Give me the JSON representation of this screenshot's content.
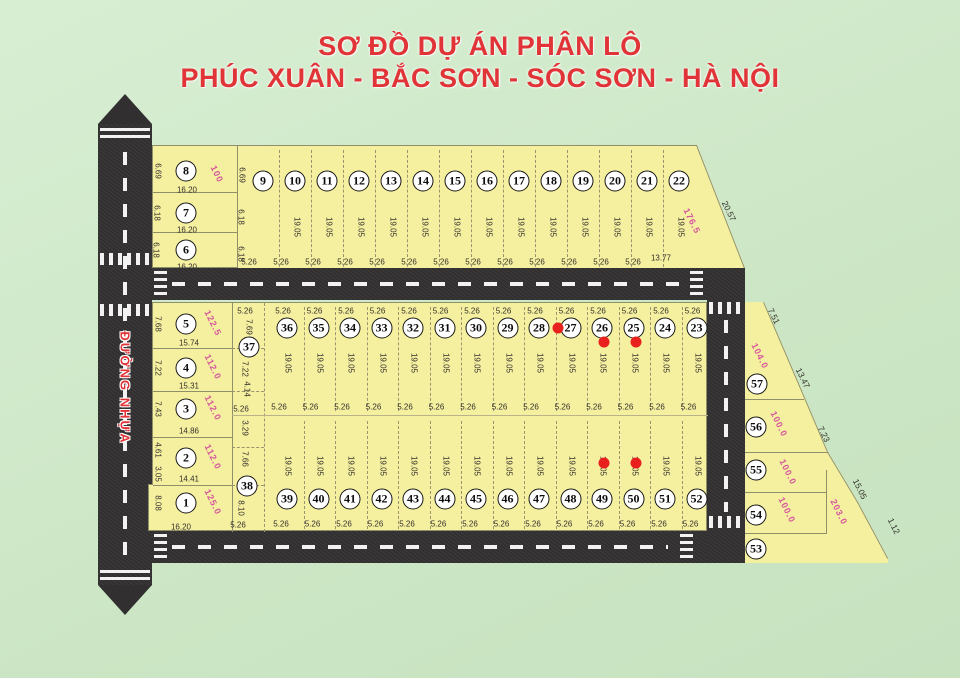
{
  "title": {
    "line1": "SƠ ĐỒ DỰ ÁN PHÂN LÔ",
    "line2": "PHÚC XUÂN - BẮC SƠN - SÓC SƠN - HÀ NỘI"
  },
  "road_label": "ĐƯỜNG NHỰA",
  "colors": {
    "background": "#cde7c6",
    "plot_fill": "#f5efa0",
    "road": "#312f30",
    "title_red": "#e13438",
    "area_pink": "#d6559c",
    "sold_dot": "#e8211f",
    "dim_text": "#33302a",
    "boundary_line": "#8f8f6a"
  },
  "top_left_block": {
    "plots": [
      {
        "num": "8",
        "left": "6.69",
        "right": "6.69",
        "bottom": "16.20",
        "area": "100"
      },
      {
        "num": "7",
        "left": "6.18",
        "right": "6.18",
        "bottom": "16.20"
      },
      {
        "num": "6",
        "left": "6.18",
        "right": "6.18",
        "bottom": "16.20"
      }
    ]
  },
  "top_row": {
    "plots": [
      {
        "num": "9",
        "width": "5.26"
      },
      {
        "num": "10",
        "width": "5.26",
        "depth": "19.05"
      },
      {
        "num": "11",
        "width": "5.26",
        "depth": "19.05"
      },
      {
        "num": "12",
        "width": "5.26",
        "depth": "19.05"
      },
      {
        "num": "13",
        "width": "5.26",
        "depth": "19.05"
      },
      {
        "num": "14",
        "width": "5.26",
        "depth": "19.05"
      },
      {
        "num": "15",
        "width": "5.26",
        "depth": "19.05"
      },
      {
        "num": "16",
        "width": "5.26",
        "depth": "19.05"
      },
      {
        "num": "17",
        "width": "5.26",
        "depth": "19.05"
      },
      {
        "num": "18",
        "width": "5.26",
        "depth": "19.05"
      },
      {
        "num": "19",
        "width": "5.26",
        "depth": "19.05"
      },
      {
        "num": "20",
        "width": "5.26",
        "depth": "19.05"
      },
      {
        "num": "21",
        "width": "5.26",
        "depth": "19.05"
      },
      {
        "num": "22",
        "width": "13.77",
        "depth": "19.05",
        "area": "176.5",
        "slant": "20.57"
      }
    ]
  },
  "left_block": {
    "plots": [
      {
        "num": "5",
        "side": "7.68",
        "bottom": "15.74",
        "area": "122.5"
      },
      {
        "num": "4",
        "side": "7.22",
        "bottom": "15.31",
        "area": "112.0"
      },
      {
        "num": "3",
        "side": "7.43",
        "bottom": "14.86",
        "area": "112.0"
      },
      {
        "num": "2",
        "side": "4.61",
        "side2": "3.05",
        "bottom": "14.41",
        "area": "112.0"
      },
      {
        "num": "1",
        "side": "8.08",
        "bottom": "16.20",
        "area": "125.0"
      }
    ]
  },
  "mid_column": {
    "top_width": "5.26",
    "upper_num": "37",
    "upper_segments": [
      "7.69",
      "7.22",
      "4.14"
    ],
    "mid_width": "5.26",
    "lower_segments": [
      "3.29",
      "7.66",
      "8.10"
    ],
    "lower_num": "38",
    "bottom_width": "5.26"
  },
  "row2": {
    "plots": [
      {
        "num": "36",
        "top": "5.26",
        "depth": "19.05",
        "mid": "5.26"
      },
      {
        "num": "35",
        "top": "5.26",
        "depth": "19.05",
        "mid": "5.26"
      },
      {
        "num": "34",
        "top": "5.26",
        "depth": "19.05",
        "mid": "5.26"
      },
      {
        "num": "33",
        "top": "5.26",
        "depth": "19.05",
        "mid": "5.26"
      },
      {
        "num": "32",
        "top": "5.26",
        "depth": "19.05",
        "mid": "5.26"
      },
      {
        "num": "31",
        "top": "5.26",
        "depth": "19.05",
        "mid": "5.26"
      },
      {
        "num": "30",
        "top": "5.26",
        "depth": "19.05",
        "mid": "5.26"
      },
      {
        "num": "29",
        "top": "5.26",
        "depth": "19.05",
        "mid": "5.26"
      },
      {
        "num": "28",
        "top": "5.26",
        "depth": "19.05",
        "mid": "5.26"
      },
      {
        "num": "27",
        "top": "5.26",
        "depth": "19.05",
        "mid": "5.26",
        "sold_dot": "left"
      },
      {
        "num": "26",
        "top": "5.26",
        "depth": "19.05",
        "mid": "5.26",
        "sold_dot": "below"
      },
      {
        "num": "25",
        "top": "5.26",
        "depth": "19.05",
        "mid": "5.26",
        "sold_dot": "below"
      },
      {
        "num": "24",
        "top": "5.26",
        "depth": "19.05",
        "mid": "5.26"
      },
      {
        "num": "23",
        "top": "5.26",
        "depth": "19.05",
        "mid": "5.26"
      }
    ]
  },
  "row3": {
    "plots": [
      {
        "num": "39",
        "depth": "19.05",
        "bottom": "5.26"
      },
      {
        "num": "40",
        "depth": "19.05",
        "bottom": "5.26"
      },
      {
        "num": "41",
        "depth": "19.05",
        "bottom": "5.26"
      },
      {
        "num": "42",
        "depth": "19.05",
        "bottom": "5.26"
      },
      {
        "num": "43",
        "depth": "19.05",
        "bottom": "5.26"
      },
      {
        "num": "44",
        "depth": "19.05",
        "bottom": "5.26"
      },
      {
        "num": "45",
        "depth": "19.05",
        "bottom": "5.26"
      },
      {
        "num": "46",
        "depth": "19.05",
        "bottom": "5.26"
      },
      {
        "num": "47",
        "depth": "19.05",
        "bottom": "5.26"
      },
      {
        "num": "48",
        "depth": "19.05",
        "bottom": "5.26"
      },
      {
        "num": "49",
        "depth": "19.05",
        "bottom": "5.26",
        "sold_dot": "above"
      },
      {
        "num": "50",
        "depth": "19.05",
        "bottom": "5.26",
        "sold_dot": "above"
      },
      {
        "num": "51",
        "depth": "19.05",
        "bottom": "5.26"
      },
      {
        "num": "52",
        "depth": "19.05",
        "bottom": "5.26"
      }
    ]
  },
  "right_block": {
    "plots": [
      {
        "num": "57",
        "area": "104.0"
      },
      {
        "num": "56",
        "area": "100.0"
      },
      {
        "num": "55",
        "area": "100.0"
      },
      {
        "num": "54",
        "area": "100.0"
      },
      {
        "num": "53"
      }
    ],
    "extra_area": "203.0",
    "edge_labels": [
      "7.51",
      "13.47",
      "7.23",
      "15.05",
      "1.12"
    ]
  }
}
